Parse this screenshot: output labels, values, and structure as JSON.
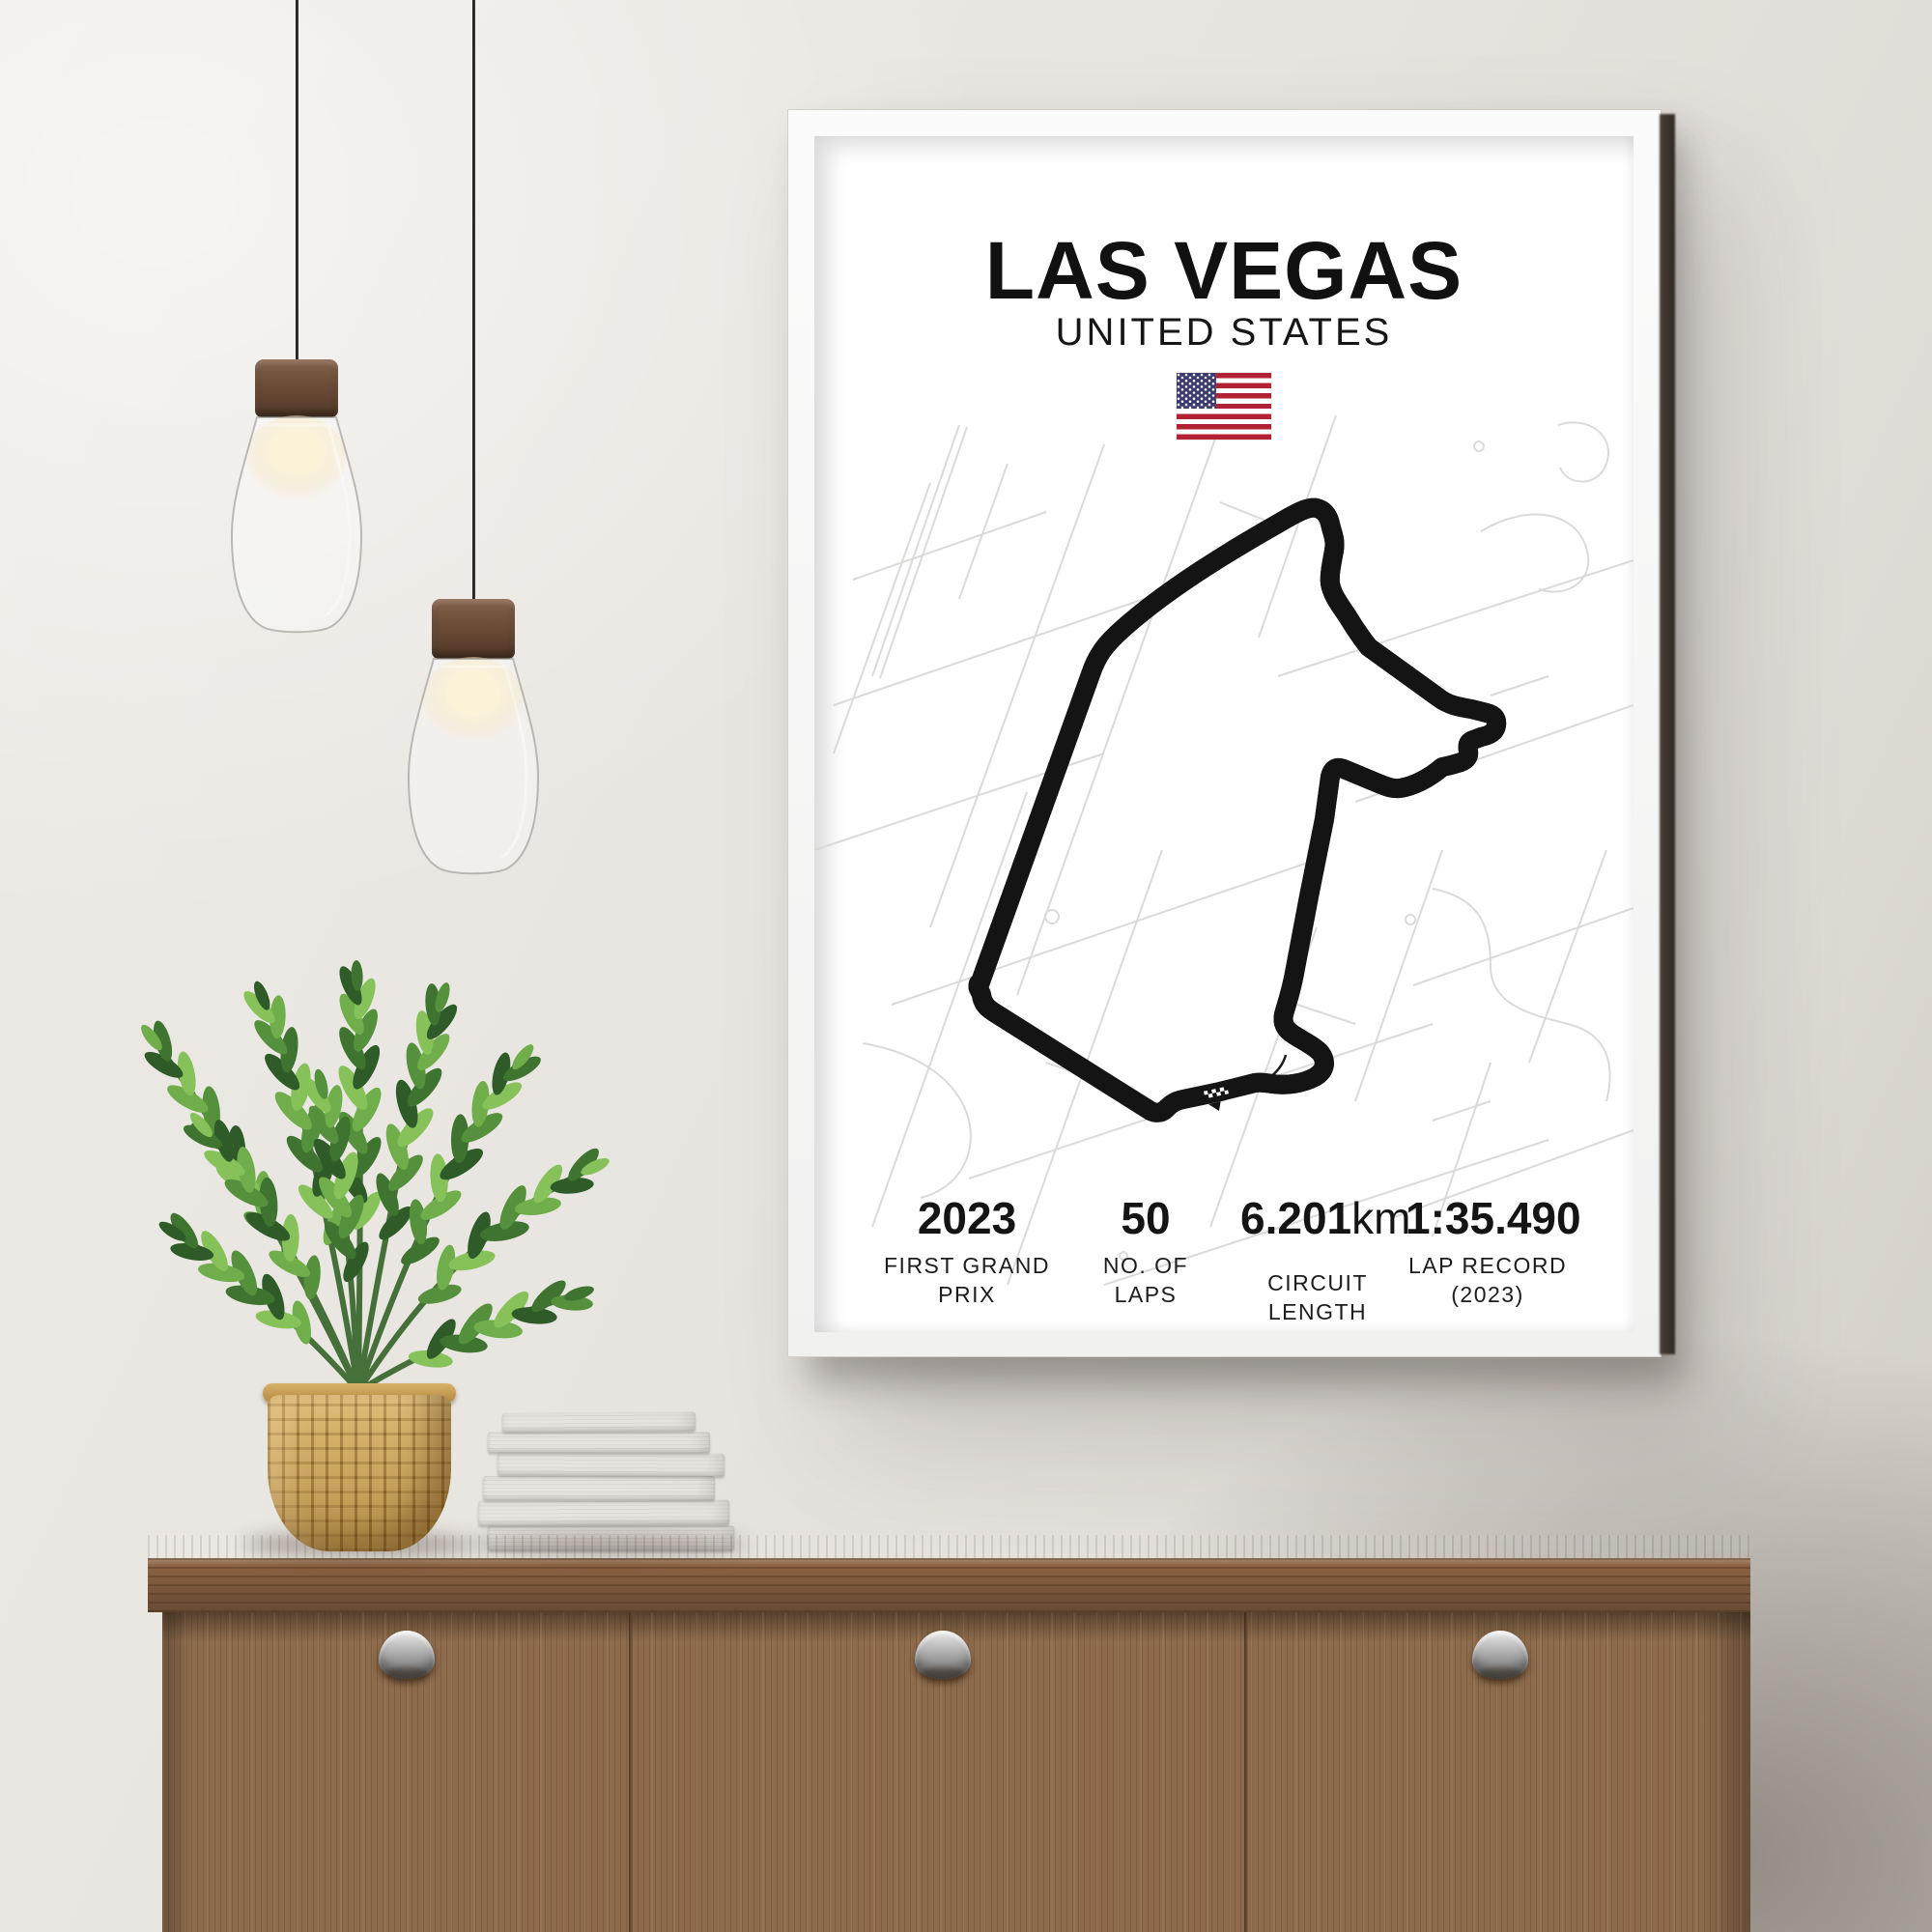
{
  "poster": {
    "title": "LAS VEGAS",
    "subtitle": "UNITED STATES",
    "flag_icon": "us-flag",
    "stats": [
      {
        "value": "2023",
        "unit": "",
        "label": "FIRST GRAND PRIX"
      },
      {
        "value": "50",
        "unit": "",
        "label": "NO. OF LAPS"
      },
      {
        "value": "6.201",
        "unit": "km",
        "label": "CIRCUIT LENGTH"
      },
      {
        "value": "1:35.490",
        "unit": "",
        "label": "LAP RECORD (2023)"
      }
    ],
    "colors": {
      "track": "#141414",
      "street": "#d7d6d4",
      "paper": "#ffffff",
      "text": "#111111",
      "flag_red": "#B22234",
      "flag_blue": "#3C3B6E"
    }
  },
  "scene": {
    "wall_color": "#e8e5e0",
    "frame_color": "#f7f7f6",
    "wood_color": "#8d6b4c",
    "pot_color": "#c59a4e",
    "leaf_color": "#4a7f35",
    "objects": [
      "pendant-lamp",
      "pendant-lamp",
      "poster",
      "zz-plant",
      "woven-pot",
      "book-stack",
      "wood-sideboard"
    ]
  }
}
